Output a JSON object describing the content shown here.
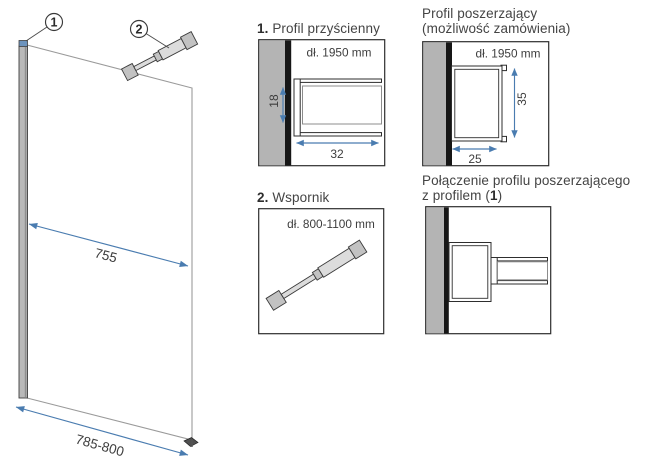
{
  "colors": {
    "dimension_blue": "#4a7cb0",
    "wall_gray": "#b4b4b4",
    "line_dark": "#2e2e2e"
  },
  "drawing": {
    "callout_wall_profile": "1",
    "callout_support": "2",
    "dim_glass_width": "755",
    "dim_total_width": "785-800"
  },
  "panel_wall_profile": {
    "number": "1.",
    "title": "Profil przyścienny",
    "length": "dł. 1950 mm",
    "dim_depth": "18",
    "dim_width": "32"
  },
  "panel_extension_profile": {
    "title_line1": "Profil poszerzający",
    "title_line2": "(możliwość zamówienia)",
    "length": "dł. 1950 mm",
    "dim_height": "35",
    "dim_width": "25"
  },
  "panel_support": {
    "number": "2.",
    "title": "Wspornik",
    "length": "dł. 800-1100 mm"
  },
  "panel_connection": {
    "title_line1": "Połączenie profilu poszerzającego",
    "line2_pre": "z profilem (",
    "line2_num": "1",
    "line2_post": ")"
  }
}
